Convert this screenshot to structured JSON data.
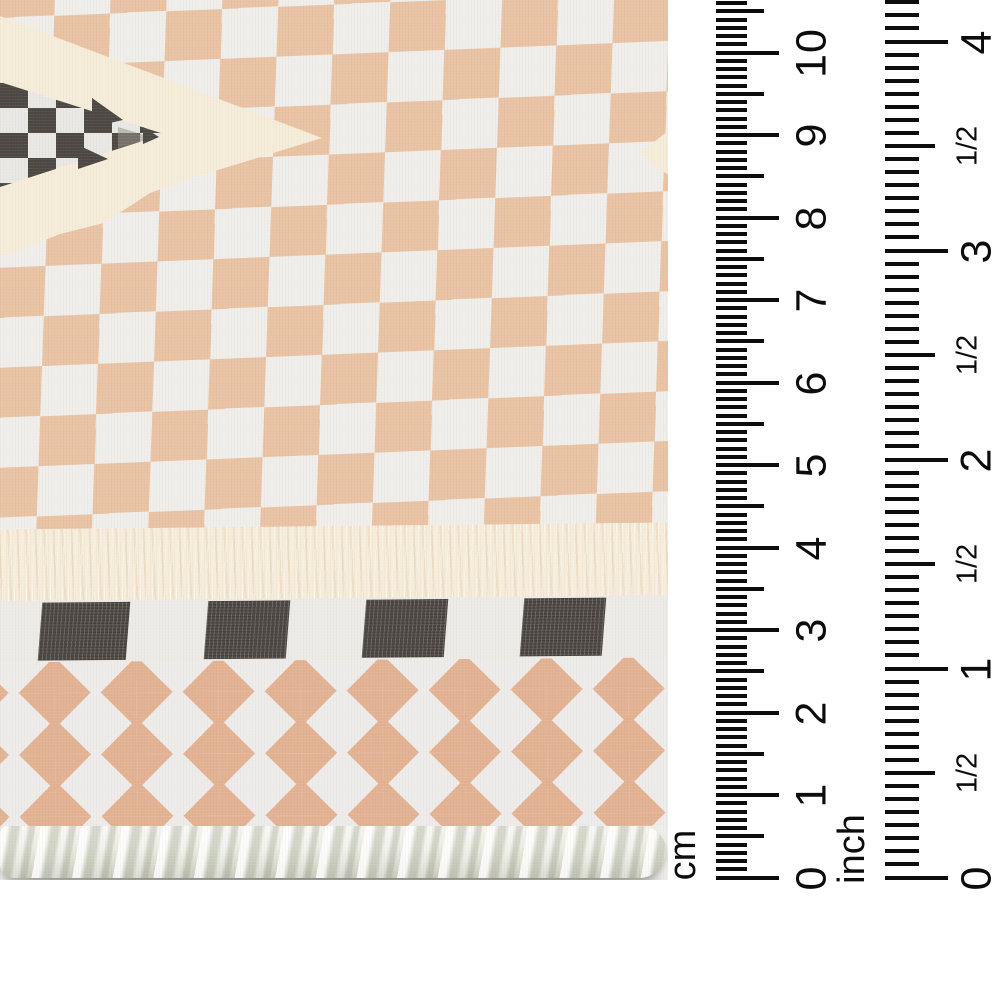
{
  "rulers": {
    "cm": {
      "unit_label": "cm",
      "numbers": [
        "0",
        "1",
        "2",
        "3",
        "4",
        "5",
        "6",
        "7",
        "8",
        "9",
        "10"
      ]
    },
    "inch": {
      "unit_label": "inch",
      "numbers": [
        "0",
        "1",
        "2",
        "3",
        "4"
      ],
      "half_label": "1/2"
    }
  },
  "palette": {
    "ruler_ink": "#0c0c0c",
    "checker_peach": "#e9c3a4",
    "checker_white": "#f0eeeb",
    "cream": "#f6ecda",
    "motif_charcoal": "#4b4742",
    "motif_light": "#e9e8e4",
    "diamond_peach": "#e3b293",
    "band_white": "#edebe8",
    "braid_ivory": "#edefe7",
    "background": "#ffffff"
  }
}
